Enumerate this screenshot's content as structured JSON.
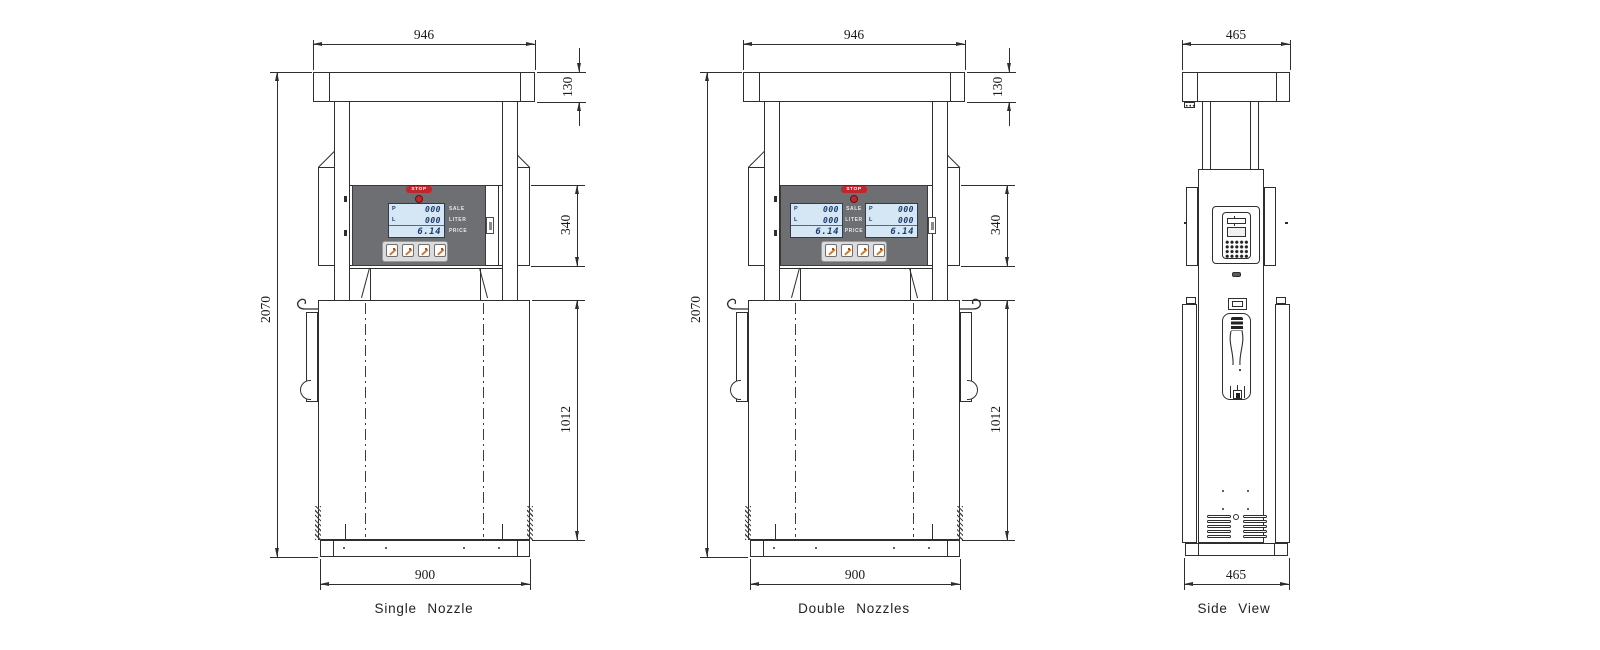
{
  "figures": {
    "single_nozzle": {
      "label": "Single Nozzle",
      "dims": {
        "width_top": "946",
        "canopy_height": "130",
        "total_height": "2070",
        "display_height": "340",
        "cabinet_height": "1012",
        "width_base": "900"
      }
    },
    "double_nozzles": {
      "label": "Double  Nozzles",
      "dims": {
        "width_top": "946",
        "canopy_height": "130",
        "total_height": "2070",
        "display_height": "340",
        "cabinet_height": "1012",
        "width_base": "900"
      }
    },
    "side_view": {
      "label": "Side View",
      "dims": {
        "width_top": "465",
        "width_base": "465"
      }
    }
  },
  "panel": {
    "stop": "STOP",
    "lcd_row1_prefix": "P",
    "lcd_row1_value": "000",
    "lcd_row2_prefix": "L",
    "lcd_row2_value": "000",
    "lcd_row3_value": "6.14",
    "label_sale": "SALE",
    "label_liter": "LITER",
    "label_price": "PRICE"
  },
  "colors": {
    "line": "#2e2e2e",
    "panel_gray": "#6d6f72",
    "lcd_blue": "#d5e7f5",
    "lcd_digit": "#1d3a6a",
    "stop_red": "#c0272d",
    "button_orange": "#d07b2f"
  }
}
